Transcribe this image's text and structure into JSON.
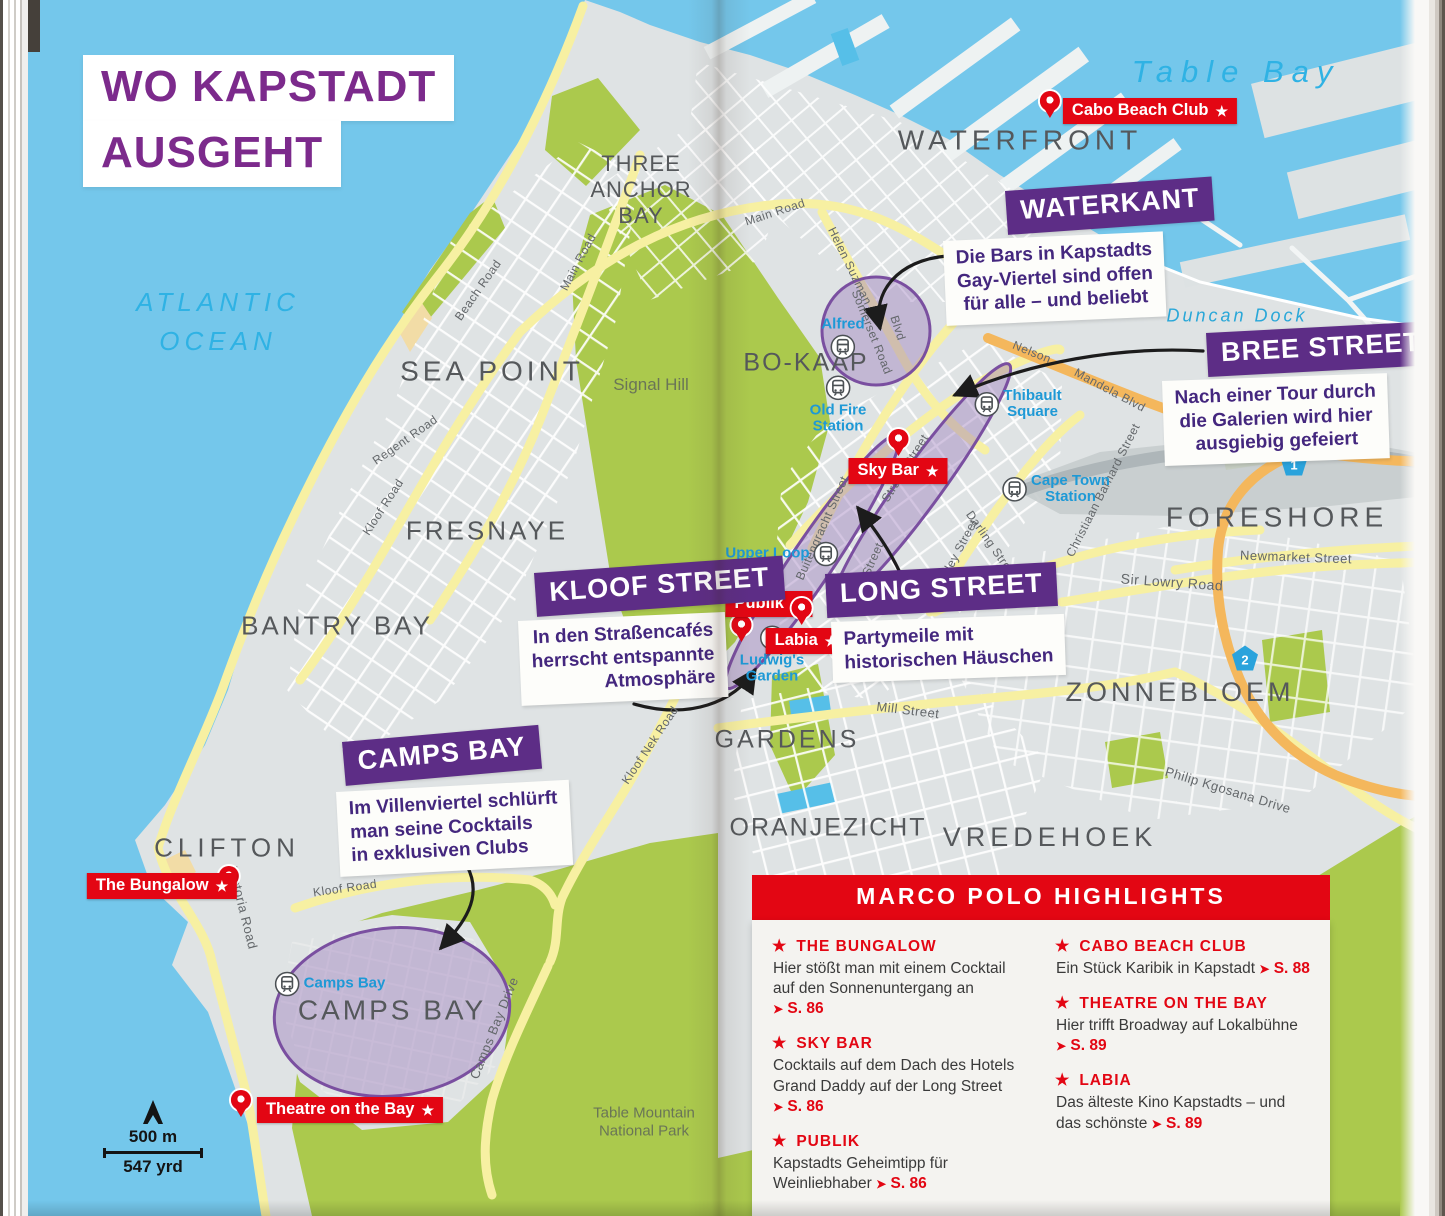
{
  "title": {
    "line1": "WO KAPSTADT",
    "line2": "AUSGEHT"
  },
  "ocean": {
    "atlantic": "ATLANTIC\nOCEAN",
    "table_bay": "Table Bay",
    "duncan_dock": "Duncan Dock"
  },
  "colors": {
    "ocean": "#74c7eb",
    "land": "#dfe3e4",
    "park_green": "#abc94d",
    "road_yellow": "#f7f0a2",
    "road_orange": "#f4b75c",
    "highlight_purple": "#9b79bd",
    "callout_purple": "#5d2d86",
    "title_purple": "#7c2a8c",
    "marco_polo_red": "#e30613",
    "station_blue": "#1e99d6",
    "district_gray": "#55585b"
  },
  "map": {
    "districts": [
      {
        "label": "THREE\nANCHOR\nBAY",
        "style": {
          "left": "641px",
          "top": "190px",
          "fontSize": "22px",
          "letterSpacing": "1px"
        }
      },
      {
        "label": "WATERFRONT",
        "style": {
          "left": "1020px",
          "top": "140px",
          "fontSize": "28px",
          "letterSpacing": "5px"
        }
      },
      {
        "label": "SEA POINT",
        "style": {
          "left": "492px",
          "top": "371px",
          "fontSize": "28px",
          "letterSpacing": "4px"
        }
      },
      {
        "label": "FRESNAYE",
        "style": {
          "left": "487px",
          "top": "531px",
          "fontSize": "26px",
          "letterSpacing": "3px"
        }
      },
      {
        "label": "BANTRY BAY",
        "style": {
          "left": "337px",
          "top": "626px",
          "fontSize": "26px",
          "letterSpacing": "3px"
        }
      },
      {
        "label": "CLIFTON",
        "style": {
          "left": "227px",
          "top": "848px",
          "fontSize": "26px",
          "letterSpacing": "5px"
        }
      },
      {
        "label": "CAMPS BAY",
        "style": {
          "left": "392px",
          "top": "1010px",
          "fontSize": "28px",
          "letterSpacing": "3px"
        }
      },
      {
        "label": "BO-KAAP",
        "style": {
          "left": "806px",
          "top": "363px",
          "fontSize": "25px",
          "letterSpacing": "2px"
        }
      },
      {
        "label": "FORESHORE",
        "style": {
          "left": "1277px",
          "top": "517px",
          "fontSize": "28px",
          "letterSpacing": "5px"
        }
      },
      {
        "label": "ZONNEBLOEM",
        "style": {
          "left": "1180px",
          "top": "693px",
          "fontSize": "27px",
          "letterSpacing": "4px"
        }
      },
      {
        "label": "GARDENS",
        "style": {
          "left": "787px",
          "top": "740px",
          "fontSize": "25px",
          "letterSpacing": "3px"
        }
      },
      {
        "label": "ORANJEZICHT",
        "style": {
          "left": "828px",
          "top": "828px",
          "fontSize": "25px",
          "letterSpacing": "2px"
        }
      },
      {
        "label": "VREDEHOEK",
        "style": {
          "left": "1050px",
          "top": "838px",
          "fontSize": "27px",
          "letterSpacing": "5px"
        }
      },
      {
        "label": "Signal Hill",
        "cls": "green-label",
        "style": {
          "left": "651px",
          "top": "385px",
          "fontSize": "17px"
        }
      },
      {
        "label": "Table Mountain\nNational Park",
        "cls": "green-label",
        "style": {
          "left": "644px",
          "top": "1122px",
          "fontSize": "15px"
        }
      }
    ],
    "streets": [
      {
        "label": "Main Road",
        "style": {
          "left": "775px",
          "top": "212px",
          "transform": "translate(-50%,-50%) rotate(-18deg)"
        }
      },
      {
        "label": "Main Road",
        "style": {
          "left": "578px",
          "top": "262px",
          "transform": "translate(-50%,-50%) rotate(-62deg)"
        }
      },
      {
        "label": "Beach Road",
        "style": {
          "left": "478px",
          "top": "290px",
          "transform": "translate(-50%,-50%) rotate(-55deg)"
        }
      },
      {
        "label": "Regent Road",
        "style": {
          "left": "405px",
          "top": "440px",
          "transform": "translate(-50%,-50%) rotate(-35deg)"
        }
      },
      {
        "label": "Kloof Road",
        "style": {
          "left": "383px",
          "top": "507px",
          "transform": "translate(-50%,-50%) rotate(-57deg)"
        }
      },
      {
        "label": "Helen Suzman",
        "style": {
          "left": "850px",
          "top": "266px",
          "transform": "translate(-50%,-50%) rotate(64deg)"
        }
      },
      {
        "label": "Blvd",
        "style": {
          "left": "898px",
          "top": "328px",
          "transform": "translate(-50%,-50%) rotate(72deg)"
        }
      },
      {
        "label": "Somerset Road",
        "style": {
          "left": "872px",
          "top": "332px",
          "transform": "translate(-50%,-50%) rotate(68deg)"
        }
      },
      {
        "label": "Nelson",
        "style": {
          "left": "1032px",
          "top": "352px",
          "transform": "translate(-50%,-50%) rotate(22deg)"
        }
      },
      {
        "label": "Mandela Blvd",
        "style": {
          "left": "1110px",
          "top": "390px",
          "transform": "translate(-50%,-50%) rotate(28deg)"
        }
      },
      {
        "label": "Buitengracht Street",
        "style": {
          "left": "822px",
          "top": "528px",
          "transform": "translate(-50%,-50%) rotate(-66deg)"
        }
      },
      {
        "label": "Strand Street",
        "style": {
          "left": "905px",
          "top": "468px",
          "transform": "translate(-50%,-50%) rotate(-58deg)"
        }
      },
      {
        "label": "Wale Street",
        "style": {
          "left": "866px",
          "top": "574px",
          "transform": "translate(-50%,-50%) rotate(-66deg)"
        }
      },
      {
        "label": "Adderley Street",
        "style": {
          "left": "953px",
          "top": "560px",
          "transform": "translate(-50%,-50%) rotate(-62deg)"
        }
      },
      {
        "label": "Darling Street",
        "style": {
          "left": "992px",
          "top": "545px",
          "transform": "translate(-50%,-50%) rotate(55deg)"
        }
      },
      {
        "label": "Christiaan Barnard Street",
        "style": {
          "left": "1103px",
          "top": "490px",
          "transform": "translate(-50%,-50%) rotate(-63deg)"
        }
      },
      {
        "label": "Sir Lowry Road",
        "style": {
          "left": "1172px",
          "top": "582px",
          "fontSize": "14px",
          "transform": "translate(-50%,-50%) rotate(4deg)"
        }
      },
      {
        "label": "Newmarket Street",
        "style": {
          "left": "1296px",
          "top": "557px",
          "fontSize": "13px",
          "transform": "translate(-50%,-50%) rotate(2deg)"
        }
      },
      {
        "label": "Mill Street",
        "style": {
          "left": "908px",
          "top": "710px",
          "fontSize": "13px",
          "transform": "translate(-50%,-50%) rotate(7deg)"
        }
      },
      {
        "label": "Philip Kgosana Drive",
        "style": {
          "left": "1228px",
          "top": "790px",
          "fontSize": "13px",
          "transform": "translate(-50%,-50%) rotate(17deg)"
        }
      },
      {
        "label": "Kloof Nek Road",
        "style": {
          "left": "650px",
          "top": "745px",
          "transform": "translate(-50%,-50%) rotate(-56deg)"
        }
      },
      {
        "label": "Camps Bay Drive",
        "style": {
          "left": "494px",
          "top": "1028px",
          "fontSize": "13px",
          "transform": "translate(-50%,-50%) rotate(-68deg)"
        }
      },
      {
        "label": "Victoria Road",
        "style": {
          "left": "243px",
          "top": "908px",
          "fontSize": "13px",
          "transform": "translate(-50%,-50%) rotate(76deg)"
        }
      },
      {
        "label": "Kloof Road",
        "style": {
          "left": "345px",
          "top": "888px",
          "transform": "translate(-50%,-50%) rotate(-8deg)"
        }
      }
    ],
    "stations": [
      {
        "label": "Alfred",
        "cls": "col icon-after",
        "style": {
          "left": "843px",
          "top": "338px"
        }
      },
      {
        "label": "Old Fire\nStation",
        "cls": "col",
        "style": {
          "left": "838px",
          "top": "405px"
        }
      },
      {
        "label": "Thibault\nSquare",
        "cls": "row",
        "style": {
          "left": "1018px",
          "top": "404px"
        }
      },
      {
        "label": "Cape Town\nStation",
        "cls": "row",
        "style": {
          "left": "1056px",
          "top": "489px"
        }
      },
      {
        "label": "Upper Loop",
        "cls": "row icon-after",
        "style": {
          "left": "782px",
          "top": "554px"
        }
      },
      {
        "label": "Ludwig's\nGarden",
        "cls": "col",
        "style": {
          "left": "772px",
          "top": "655px"
        }
      },
      {
        "label": "Camps Bay",
        "cls": "row",
        "style": {
          "left": "330px",
          "top": "984px"
        }
      }
    ],
    "pois": [
      {
        "label": "Cabo Beach Club",
        "style": {
          "left": "1150px",
          "top": "111px"
        },
        "pin": {
          "left": "-23px",
          "top": "-7px"
        }
      },
      {
        "label": "Sky Bar",
        "style": {
          "left": "898px",
          "top": "471px"
        },
        "pin": {
          "left": "40px",
          "top": "-29px"
        }
      },
      {
        "label": "Publik",
        "style": {
          "left": "769px",
          "top": "604px"
        },
        "pin": {
          "left": "6px",
          "top": "24px"
        }
      },
      {
        "label": "Labia",
        "style": {
          "left": "806px",
          "top": "641px"
        },
        "pin": {
          "left": "26px",
          "top": "-30px"
        }
      },
      {
        "label": "The Bungalow",
        "style": {
          "left": "162px",
          "top": "886px"
        },
        "pin": {
          "left": "132px",
          "top": "-7px"
        }
      },
      {
        "label": "Theatre on the Bay",
        "style": {
          "left": "350px",
          "top": "1110px"
        },
        "pin": {
          "left": "-26px",
          "top": "-7px"
        }
      }
    ],
    "shields": [
      {
        "label": "1",
        "style": {
          "left": "1294px",
          "top": "463px"
        }
      },
      {
        "label": "2",
        "style": {
          "left": "1245px",
          "top": "658px"
        }
      }
    ]
  },
  "callouts": {
    "waterkant": {
      "title": "WATERKANT",
      "text": "Die Bars in Kapstadts\nGay-Viertel sind offen\nfür alle – und beliebt"
    },
    "bree": {
      "title": "BREE STREET",
      "text": "Nach einer Tour durch\ndie Galerien wird hier\nausgiebig gefeiert"
    },
    "kloof": {
      "title": "KLOOF STREET",
      "text": "In den Straßencafés\nherrscht entspannte\nAtmosphäre"
    },
    "long": {
      "title": "LONG STREET",
      "text": "Partymeile mit\nhistorischen Häuschen"
    },
    "camps": {
      "title": "CAMPS BAY",
      "text": "Im Villenviertel schlürft\nman seine Cocktails\nin exklusiven Clubs"
    }
  },
  "highlights": {
    "header": "MARCO POLO HIGHLIGHTS",
    "left": [
      {
        "name": "THE BUNGALOW",
        "desc": "Hier stößt man mit einem Cocktail auf den Sonnenuntergang an",
        "page": "S. 86"
      },
      {
        "name": "SKY BAR",
        "desc": "Cocktails auf dem Dach des Hotels Grand Daddy auf der Long Street",
        "page": "S. 86"
      },
      {
        "name": "PUBLIK",
        "desc": "Kapstadts Geheimtipp für Weinliebhaber",
        "page": "S. 86"
      }
    ],
    "right": [
      {
        "name": "CABO BEACH CLUB",
        "desc": "Ein Stück Karibik in Kapstadt",
        "page": "S. 88"
      },
      {
        "name": "THEATRE ON THE BAY",
        "desc": "Hier trifft Broadway auf Lokalbühne",
        "page": "S. 89"
      },
      {
        "name": "LABIA",
        "desc": "Das älteste Kino Kapstadts – und das schönste",
        "page": "S. 89"
      }
    ]
  },
  "scale": {
    "metric": "500 m",
    "imperial": "547 yrd"
  }
}
